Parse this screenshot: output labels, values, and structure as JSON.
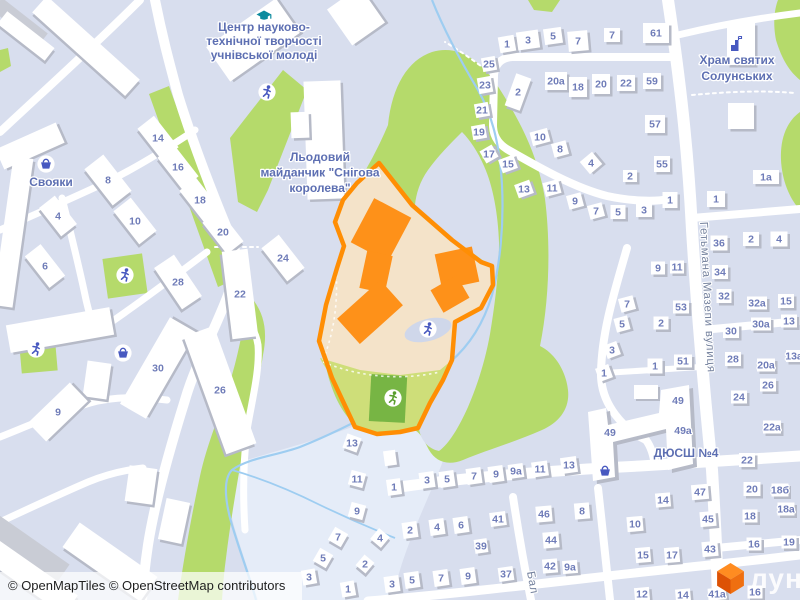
{
  "map": {
    "attribution": "© OpenMapTiles © OpenStreetMap contributors",
    "logo_text": "лун",
    "colors": {
      "bg": "#d8deee",
      "road": "#ffffff",
      "green": "#b5da6b",
      "green_yellow": "#cede79",
      "green_dark": "#77b544",
      "pale": "#e5ecf8",
      "water": "#9ecdf1",
      "building": "#ffffff",
      "building_shadow": "#b6bac7",
      "building_gray": "#c9ccd5",
      "highlight_fill": "#f4e3c9",
      "highlight_line": "#ff8e04",
      "highlight_building": "#fe9119",
      "lavender_blob": "#cfd7ea",
      "label": "#5d6fb2",
      "number": "#6f7cb8",
      "street": "#75829e",
      "icon_blue": "#4859c0",
      "icon_teal": "#0d8a9e",
      "icon_green": "#5a9e2f",
      "attribution_text": "#1f1f1f",
      "logo_top": "#ff8c21",
      "logo_left": "#dd5205",
      "logo_right": "#ef6f10",
      "logo_text": "rgba(255,255,255,0.88)"
    },
    "pois": [
      {
        "name": "education-center",
        "lines": [
          "Центр науково-",
          "технічної творчості",
          "учнівської молоді"
        ],
        "x": 264,
        "y": 31,
        "lh": 14,
        "icon": "grad-cap",
        "ix": 264,
        "iy": 15,
        "ic": "icon_teal"
      },
      {
        "name": "ice-rink",
        "lines": [
          "Льодовий",
          "майданчик \"Снігова",
          "королева\""
        ],
        "x": 320,
        "y": 161,
        "lh": 15.5
      },
      {
        "name": "store-svoiaky",
        "lines": [
          "Свояки"
        ],
        "x": 51,
        "y": 186,
        "lh": 14
      },
      {
        "name": "church-thessaloniki",
        "lines": [
          "Храм святих",
          "Солунських"
        ],
        "x": 737,
        "y": 64,
        "lh": 16,
        "icon": "church",
        "ix": 736,
        "iy": 45,
        "ic": "icon_blue"
      },
      {
        "name": "sports-school",
        "lines": [
          "ДЮСШ №4"
        ],
        "x": 686,
        "y": 457,
        "lh": 14
      }
    ],
    "streets": [
      {
        "label": "Гетьмана Мазепи вулиця",
        "x": 700,
        "y": 222,
        "r": 87
      },
      {
        "label": "Бал",
        "x": 527,
        "y": 572,
        "r": 80
      }
    ],
    "icons": [
      {
        "t": "playground",
        "x": 267,
        "y": 92,
        "c": "icon_blue"
      },
      {
        "t": "playground",
        "x": 125,
        "y": 275,
        "c": "icon_blue"
      },
      {
        "t": "playground",
        "x": 36,
        "y": 349,
        "c": "icon_blue"
      },
      {
        "t": "playground",
        "x": 428,
        "y": 329,
        "c": "icon_blue"
      },
      {
        "t": "playground",
        "x": 393,
        "y": 398,
        "c": "icon_green"
      },
      {
        "t": "basket",
        "x": 46,
        "y": 164,
        "circle": true,
        "c": "icon_blue"
      },
      {
        "t": "basket",
        "x": 123,
        "y": 353,
        "circle": true,
        "c": "icon_blue"
      },
      {
        "t": "basket",
        "x": 605,
        "y": 471,
        "circle": false,
        "c": "icon_blue"
      }
    ],
    "extra_labels": [
      {
        "t": "49",
        "x": 610,
        "y": 436
      },
      {
        "t": "49",
        "x": 678,
        "y": 404
      },
      {
        "t": "49a",
        "x": 683,
        "y": 434
      }
    ],
    "buildings": [
      [
        "",
        20,
        22,
        58,
        16,
        38,
        "g"
      ],
      [
        "",
        26,
        36,
        60,
        16,
        38
      ],
      [
        "",
        86,
        46,
        125,
        22,
        42
      ],
      [
        "",
        30,
        146,
        66,
        22,
        -24
      ],
      [
        "",
        13,
        232,
        20,
        150,
        8
      ],
      [
        "",
        60,
        330,
        105,
        28,
        -10
      ],
      [
        "",
        97,
        380,
        24,
        36,
        8
      ],
      [
        "",
        253,
        40,
        85,
        42,
        -35
      ],
      [
        "",
        356,
        16,
        40,
        44,
        -35
      ],
      [
        "",
        324,
        140,
        37,
        118,
        -2
      ],
      [
        "",
        300,
        125,
        18,
        26,
        -2
      ],
      [
        "",
        25,
        548,
        92,
        24,
        35,
        "g"
      ],
      [
        "",
        32,
        578,
        95,
        24,
        35
      ],
      [
        "",
        110,
        562,
        95,
        30,
        35
      ],
      [
        "",
        141,
        485,
        28,
        36,
        8
      ],
      [
        "",
        174,
        521,
        24,
        42,
        12
      ],
      [
        "",
        741,
        44,
        28,
        42,
        0
      ],
      [
        "",
        741,
        116,
        26,
        26,
        0
      ],
      [
        "",
        390,
        458,
        12,
        15,
        -8
      ],
      [
        "9",
        58,
        412,
        58,
        26,
        -44
      ],
      [
        "14",
        158,
        138,
        40,
        21,
        52
      ],
      [
        "16",
        178,
        167,
        40,
        21,
        52
      ],
      [
        "18",
        200,
        200,
        40,
        21,
        52
      ],
      [
        "20",
        223,
        232,
        40,
        21,
        52
      ],
      [
        "8",
        108,
        180,
        46,
        24,
        52
      ],
      [
        "10",
        135,
        221,
        42,
        22,
        52
      ],
      [
        "4",
        58,
        216,
        36,
        20,
        52
      ],
      [
        "6",
        45,
        266,
        40,
        20,
        52
      ],
      [
        "24",
        283,
        258,
        42,
        22,
        52
      ],
      [
        "28",
        178,
        282,
        50,
        24,
        56
      ],
      [
        "22",
        240,
        294,
        88,
        26,
        83
      ],
      [
        "30",
        158,
        368,
        100,
        30,
        -60
      ],
      [
        "26",
        220,
        390,
        125,
        32,
        70
      ],
      [
        "1",
        507,
        44,
        16,
        16,
        -10
      ],
      [
        "3",
        528,
        40,
        22,
        18,
        -8
      ],
      [
        "5",
        553,
        36,
        18,
        16,
        -8
      ],
      [
        "7",
        578,
        41,
        20,
        20,
        -5
      ],
      [
        "7",
        612,
        35,
        16,
        14,
        0
      ],
      [
        "61",
        656,
        33,
        26,
        20,
        0
      ],
      [
        "25",
        489,
        64,
        14,
        14,
        -10
      ],
      [
        "23",
        485,
        85,
        14,
        16,
        -10
      ],
      [
        "21",
        482,
        110,
        14,
        14,
        -10
      ],
      [
        "19",
        479,
        132,
        14,
        14,
        -10
      ],
      [
        "17",
        489,
        154,
        14,
        14,
        -30
      ],
      [
        "15",
        508,
        164,
        16,
        14,
        -20
      ],
      [
        "13",
        524,
        189,
        16,
        14,
        -20
      ],
      [
        "11",
        552,
        188,
        16,
        14,
        -15
      ],
      [
        "9",
        575,
        201,
        15,
        14,
        -15
      ],
      [
        "7",
        596,
        211,
        15,
        14,
        -15
      ],
      [
        "5",
        618,
        212,
        15,
        14,
        0
      ],
      [
        "3",
        644,
        210,
        16,
        14,
        0
      ],
      [
        "1",
        670,
        200,
        15,
        16,
        0
      ],
      [
        "2",
        518,
        92,
        16,
        34,
        20
      ],
      [
        "20a",
        556,
        81,
        22,
        18,
        0
      ],
      [
        "18",
        578,
        87,
        18,
        20,
        0
      ],
      [
        "20",
        601,
        84,
        18,
        20,
        0
      ],
      [
        "22",
        626,
        83,
        18,
        16,
        0
      ],
      [
        "59",
        652,
        81,
        18,
        16,
        0
      ],
      [
        "57",
        655,
        124,
        20,
        18,
        0
      ],
      [
        "55",
        662,
        164,
        16,
        16,
        0
      ],
      [
        "2",
        630,
        176,
        14,
        12,
        0
      ],
      [
        "10",
        540,
        137,
        18,
        14,
        -15
      ],
      [
        "8",
        560,
        149,
        15,
        14,
        -15
      ],
      [
        "4",
        591,
        163,
        16,
        16,
        -40
      ],
      [
        "7",
        627,
        304,
        15,
        14,
        -15
      ],
      [
        "5",
        622,
        324,
        14,
        14,
        -15
      ],
      [
        "3",
        612,
        350,
        14,
        14,
        -20
      ],
      [
        "1",
        604,
        373,
        14,
        14,
        -20
      ],
      [
        "2",
        661,
        323,
        15,
        13,
        0
      ],
      [
        "53",
        681,
        307,
        16,
        13,
        0
      ],
      [
        "51",
        683,
        361,
        18,
        13,
        0
      ],
      [
        "1",
        655,
        366,
        15,
        15,
        0
      ],
      [
        "9",
        658,
        268,
        14,
        13,
        0
      ],
      [
        "11",
        677,
        267,
        14,
        13,
        0
      ],
      [
        "1a",
        766,
        177,
        26,
        14,
        0
      ],
      [
        "1",
        716,
        199,
        18,
        16,
        0
      ],
      [
        "36",
        719,
        243,
        17,
        15,
        0
      ],
      [
        "2",
        751,
        239,
        16,
        14,
        0
      ],
      [
        "4",
        779,
        239,
        17,
        15,
        0
      ],
      [
        "34",
        720,
        272,
        16,
        14,
        0
      ],
      [
        "32",
        724,
        296,
        15,
        14,
        0
      ],
      [
        "32a",
        757,
        303,
        20,
        13,
        0
      ],
      [
        "15",
        786,
        301,
        16,
        14,
        0
      ],
      [
        "30",
        731,
        331,
        16,
        14,
        0
      ],
      [
        "30a",
        761,
        324,
        20,
        13,
        0
      ],
      [
        "13",
        789,
        321,
        16,
        13,
        0
      ],
      [
        "28",
        733,
        359,
        16,
        14,
        0
      ],
      [
        "13a",
        794,
        356,
        16,
        12,
        0
      ],
      [
        "20a",
        766,
        365,
        18,
        13,
        0
      ],
      [
        "26",
        768,
        385,
        16,
        13,
        0
      ],
      [
        "24",
        739,
        397,
        16,
        13,
        0
      ],
      [
        "22a",
        772,
        427,
        18,
        13,
        0
      ],
      [
        "22",
        747,
        460,
        16,
        14,
        0
      ],
      [
        "20",
        752,
        489,
        17,
        14,
        0
      ],
      [
        "18б",
        780,
        490,
        17,
        13,
        0
      ],
      [
        "18",
        750,
        516,
        15,
        13,
        0
      ],
      [
        "18a",
        786,
        509,
        17,
        13,
        0
      ],
      [
        "16",
        754,
        544,
        15,
        13,
        0
      ],
      [
        "19",
        789,
        542,
        15,
        13,
        0
      ],
      [
        "16",
        755,
        592,
        15,
        13,
        0
      ],
      [
        "3",
        427,
        480,
        15,
        16,
        -8
      ],
      [
        "5",
        447,
        479,
        15,
        16,
        -8
      ],
      [
        "7",
        474,
        476,
        15,
        16,
        -8
      ],
      [
        "9",
        496,
        474,
        15,
        16,
        -8
      ],
      [
        "9a",
        516,
        471,
        15,
        14,
        -8
      ],
      [
        "11",
        540,
        469,
        16,
        15,
        -8
      ],
      [
        "13",
        569,
        465,
        16,
        16,
        -8
      ],
      [
        "1",
        394,
        487,
        14,
        16,
        -8
      ],
      [
        "2",
        410,
        530,
        15,
        16,
        -8
      ],
      [
        "4",
        437,
        527,
        15,
        16,
        -8
      ],
      [
        "6",
        461,
        525,
        15,
        16,
        -8
      ],
      [
        "41",
        498,
        519,
        16,
        14,
        -8
      ],
      [
        "39",
        481,
        546,
        13,
        14,
        -8
      ],
      [
        "4",
        380,
        538,
        14,
        14,
        40
      ],
      [
        "2",
        365,
        564,
        13,
        14,
        40
      ],
      [
        "3",
        392,
        584,
        15,
        16,
        -8
      ],
      [
        "5",
        412,
        580,
        15,
        16,
        -8
      ],
      [
        "7",
        441,
        578,
        15,
        16,
        -8
      ],
      [
        "9",
        468,
        576,
        15,
        16,
        -8
      ],
      [
        "37",
        506,
        574,
        15,
        14,
        -8
      ],
      [
        "3",
        309,
        577,
        14,
        15,
        -10
      ],
      [
        "1",
        348,
        589,
        14,
        15,
        -10
      ],
      [
        "13",
        352,
        443,
        15,
        15,
        20
      ],
      [
        "11",
        357,
        479,
        15,
        15,
        15
      ],
      [
        "9",
        357,
        511,
        15,
        15,
        15
      ],
      [
        "7",
        338,
        537,
        15,
        15,
        30
      ],
      [
        "5",
        323,
        558,
        15,
        15,
        30
      ],
      [
        "46",
        544,
        514,
        16,
        16,
        -5
      ],
      [
        "44",
        551,
        540,
        16,
        16,
        -5
      ],
      [
        "42",
        550,
        566,
        15,
        14,
        -5
      ],
      [
        "9a",
        570,
        567,
        15,
        13,
        -5
      ],
      [
        "8",
        582,
        511,
        15,
        16,
        -5
      ],
      [
        "10",
        635,
        524,
        16,
        15,
        -5
      ],
      [
        "14",
        663,
        500,
        15,
        14,
        -5
      ],
      [
        "47",
        700,
        492,
        17,
        15,
        -5
      ],
      [
        "45",
        708,
        519,
        16,
        15,
        -5
      ],
      [
        "43",
        710,
        549,
        16,
        15,
        -5
      ],
      [
        "15",
        643,
        555,
        15,
        15,
        -5
      ],
      [
        "17",
        672,
        555,
        15,
        15,
        -5
      ],
      [
        "12",
        642,
        594,
        15,
        13,
        -5
      ],
      [
        "14",
        683,
        595,
        15,
        12,
        -5
      ],
      [
        "41a",
        717,
        594,
        18,
        12,
        -5
      ]
    ]
  }
}
